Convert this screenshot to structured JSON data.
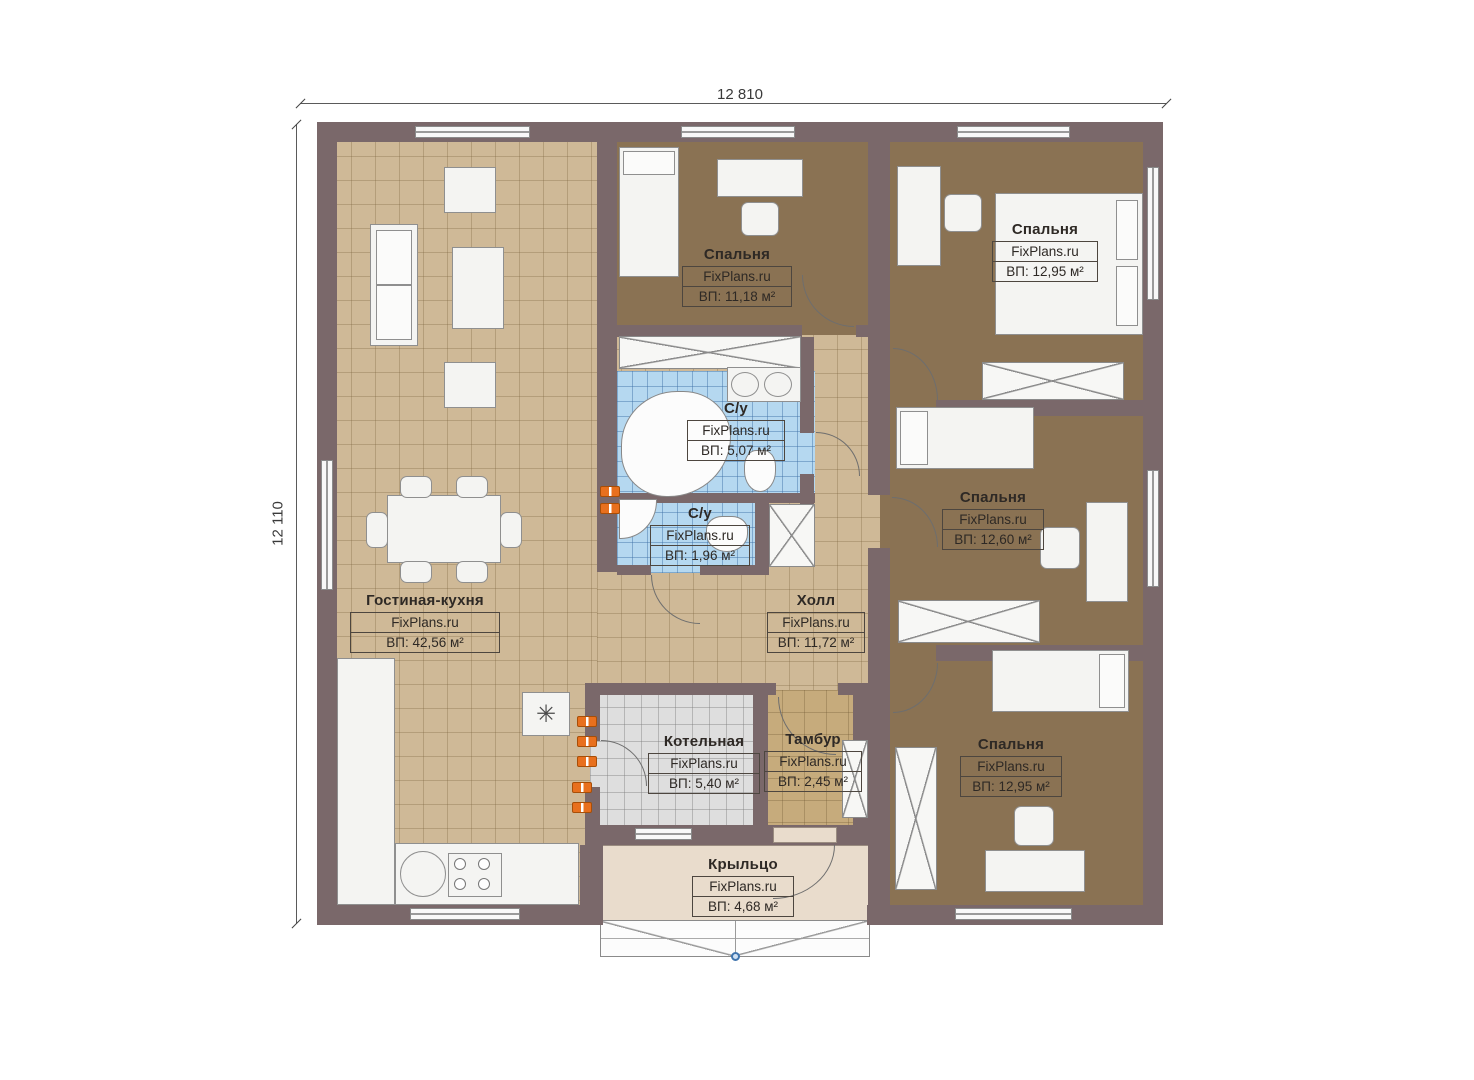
{
  "dimensions": {
    "top": "12 810",
    "left": "12 110"
  },
  "icons": {
    "boiler": "✳"
  },
  "colors": {
    "wall": "#7a686a",
    "floor_living": "#cfb997",
    "floor_bedroom": "#8a7253",
    "floor_bath": "#b5d8f0",
    "floor_boiler": "#dedede",
    "floor_porch": "#e9dccc",
    "radiator": "#e8701e"
  },
  "rooms": [
    {
      "name": "Гостиная-кухня",
      "watermark": "FixPlans.ru",
      "area": "ВП: 42,56 м²"
    },
    {
      "name": "Спальня",
      "watermark": "FixPlans.ru",
      "area": "ВП: 11,18 м²"
    },
    {
      "name": "С/у",
      "watermark": "FixPlans.ru",
      "area": "ВП: 5,07 м²"
    },
    {
      "name": "С/у",
      "watermark": "FixPlans.ru",
      "area": "ВП: 1,96 м²"
    },
    {
      "name": "Холл",
      "watermark": "FixPlans.ru",
      "area": "ВП: 11,72 м²"
    },
    {
      "name": "Спальня",
      "watermark": "FixPlans.ru",
      "area": "ВП: 12,95 м²"
    },
    {
      "name": "Спальня",
      "watermark": "FixPlans.ru",
      "area": "ВП: 12,60 м²"
    },
    {
      "name": "Спальня",
      "watermark": "FixPlans.ru",
      "area": "ВП: 12,95 м²"
    },
    {
      "name": "Котельная",
      "watermark": "FixPlans.ru",
      "area": "ВП: 5,40 м²"
    },
    {
      "name": "Тамбур",
      "watermark": "FixPlans.ru",
      "area": "ВП: 2,45 м²"
    },
    {
      "name": "Крыльцо",
      "watermark": "FixPlans.ru",
      "area": "ВП: 4,68 м²"
    }
  ]
}
